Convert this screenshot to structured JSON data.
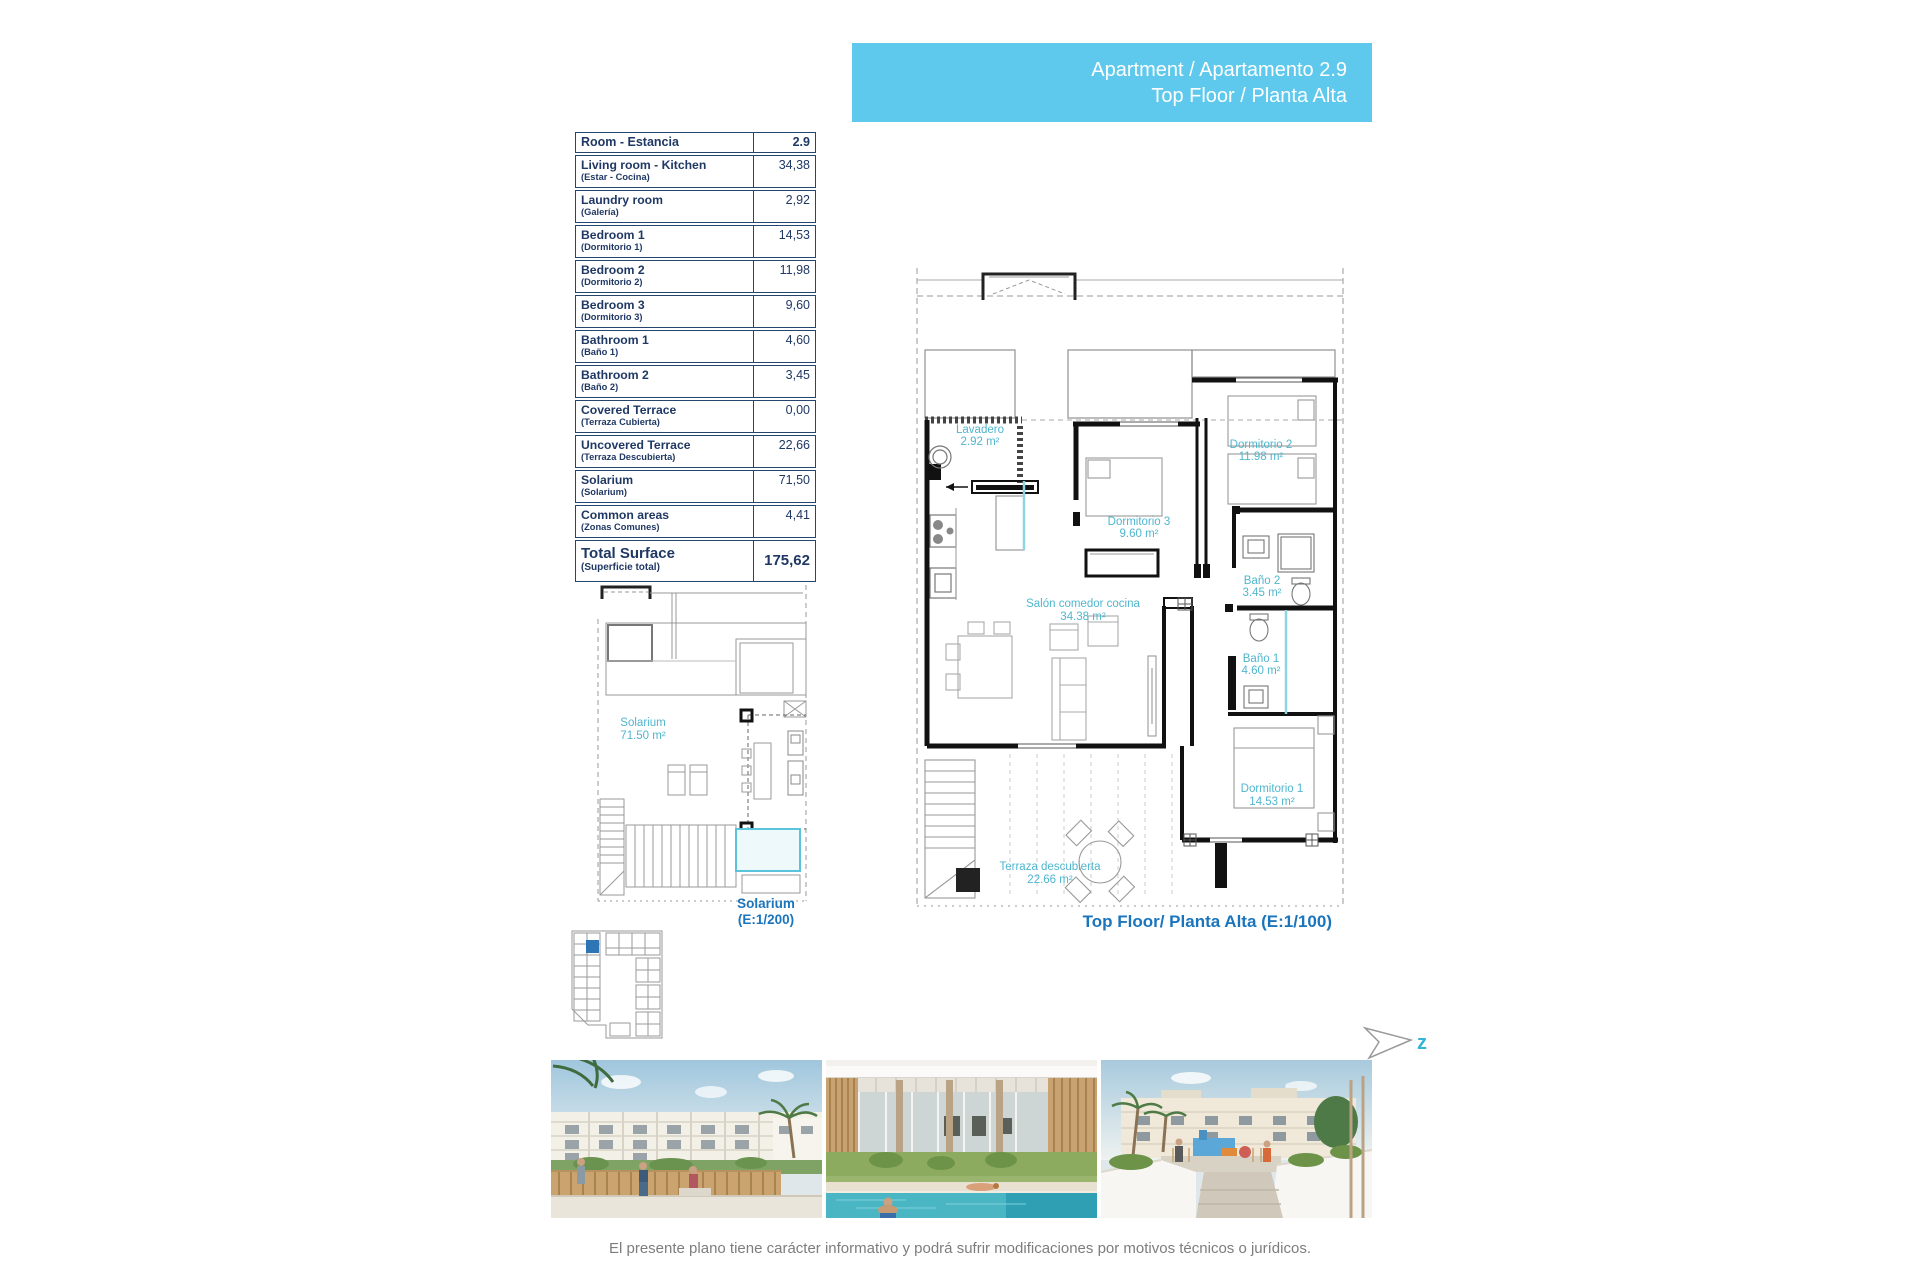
{
  "banner": {
    "line1": "Apartment / Apartamento 2.9",
    "line2": "Top Floor / Planta Alta"
  },
  "table": {
    "header": {
      "room": "Room - Estancia",
      "unit": "2.9"
    },
    "rows": [
      {
        "en": "Living room - Kitchen",
        "es": "(Estar - Cocina)",
        "value": "34,38"
      },
      {
        "en": "Laundry room",
        "es": "(Galería)",
        "value": "2,92"
      },
      {
        "en": "Bedroom 1",
        "es": "(Dormitorio 1)",
        "value": "14,53"
      },
      {
        "en": "Bedroom 2",
        "es": "(Dormitorio 2)",
        "value": "11,98"
      },
      {
        "en": "Bedroom 3",
        "es": "(Dormitorio 3)",
        "value": "9,60"
      },
      {
        "en": "Bathroom 1",
        "es": "(Baño 1)",
        "value": "4,60"
      },
      {
        "en": "Bathroom 2",
        "es": "(Baño 2)",
        "value": "3,45"
      },
      {
        "en": "Covered Terrace",
        "es": "(Terraza Cubierta)",
        "value": "0,00"
      },
      {
        "en": "Uncovered Terrace",
        "es": "(Terraza Descubierta)",
        "value": "22,66"
      },
      {
        "en": "Solarium",
        "es": "(Solarium)",
        "value": "71,50"
      },
      {
        "en": "Common areas",
        "es": "(Zonas Comunes)",
        "value": "4,41"
      }
    ],
    "total": {
      "en": "Total Surface",
      "es": "(Superficie total)",
      "value": "175,62"
    }
  },
  "solarium_plan": {
    "label": "Solarium",
    "area": "71.50 m²",
    "caption_line1": "Solarium",
    "caption_line2": "(E:1/200)"
  },
  "main_plan": {
    "rooms": {
      "lavadero": {
        "label": "Lavadero",
        "area": "2.92 m²"
      },
      "dormitorio3": {
        "label": "Dormitorio 3",
        "area": "9.60 m²"
      },
      "dormitorio2": {
        "label": "Dormitorio 2",
        "area": "11.98 m²"
      },
      "bano2": {
        "label": "Baño 2",
        "area": "3.45 m²"
      },
      "salon": {
        "label": "Salón comedor cocina",
        "area": "34.38 m²"
      },
      "bano1": {
        "label": "Baño 1",
        "area": "4.60 m²"
      },
      "dormitorio1": {
        "label": "Dormitorio 1",
        "area": "14.53 m²"
      },
      "terraza": {
        "label": "Terraza descubierta",
        "area": "22.66 m²"
      }
    },
    "caption": "Top Floor/ Planta Alta (E:1/100)"
  },
  "north_arrow": {
    "letter": "z"
  },
  "disclaimer": "El presente plano tiene carácter informativo y podrá sufrir modificaciones por motivos técnicos o jurídicos.",
  "colors": {
    "banner_bg": "#5ec9ec",
    "table_text": "#1f3864",
    "plan_label": "#4fb6ce",
    "caption_blue": "#1b75bc",
    "keyplan_highlight": "#2e75b6",
    "disclaimer_gray": "#7d7d7d"
  }
}
